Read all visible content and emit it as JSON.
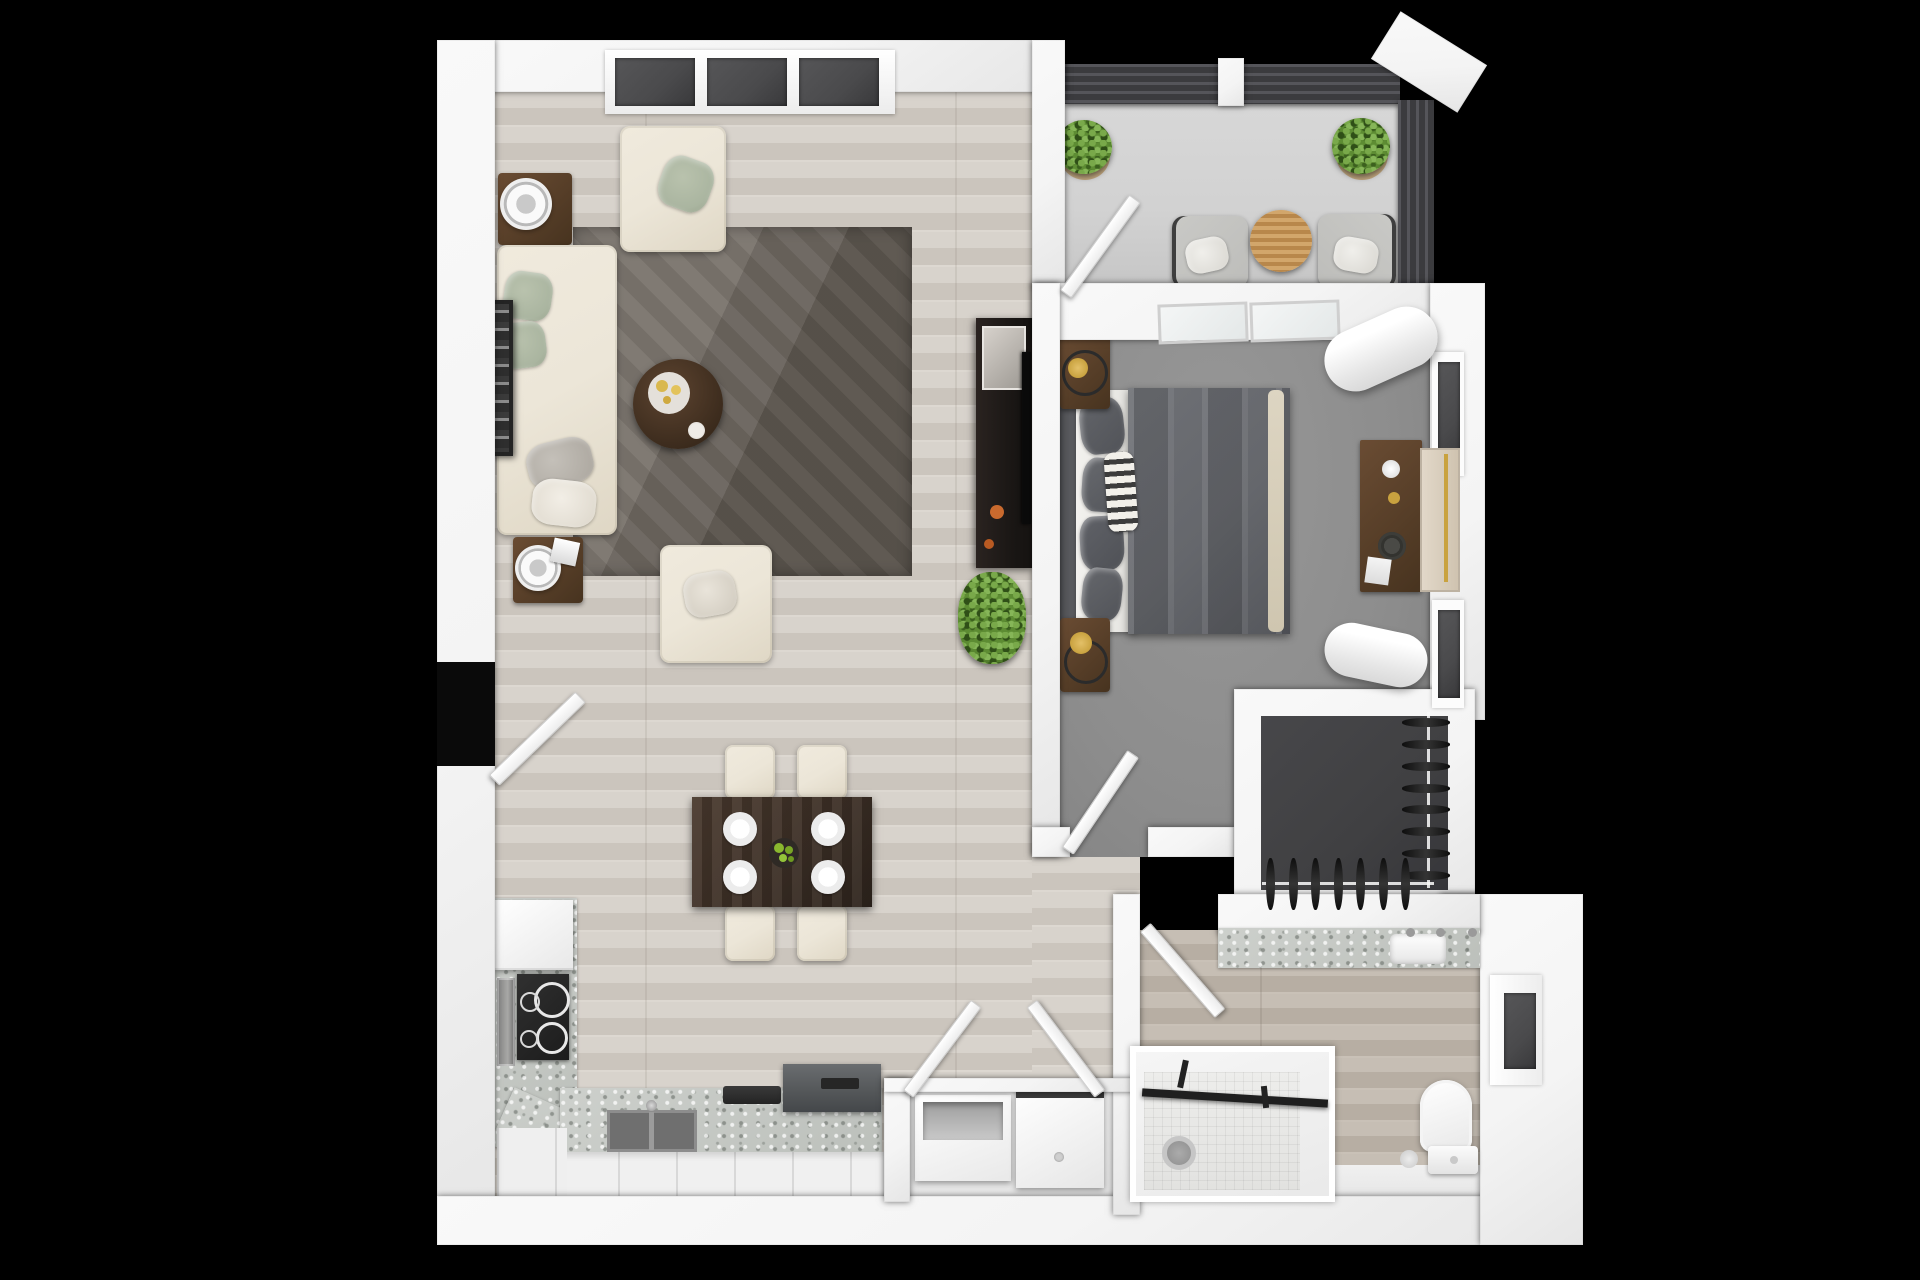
{
  "scene": {
    "type": "3d-rendered-floor-plan",
    "background": "#000000",
    "style": "top-down dollhouse render, furnished one-bedroom apartment"
  },
  "palette": {
    "wall": "#f4f4f4",
    "wall-deep": "#e6e6e6",
    "wood-a": "#d8d3cc",
    "wood-b": "#cbc5bd",
    "bathwood-a": "#c6beb4",
    "bathwood-b": "#b7aea3",
    "carpet": "#8d8d8d",
    "concrete": "#d2d2d2",
    "rug-a": "#7b756e",
    "rug-b": "#5a544d",
    "closet-floor": "#404042",
    "cream": "#ece6d8",
    "sage": "#aab5a0",
    "darkwood-a": "#6a4c33",
    "darkwood-b": "#47331f",
    "table-dark": "#3b2e25",
    "duvet": "#65676c",
    "granite-a": "#cdd0cc",
    "granite-b": "#bcc0bb",
    "appliance": "#55585a",
    "railing": "#3b3b3e",
    "glass": "#4a4a4c",
    "plant": "#5d8c33",
    "plant-dark": "#3f661f",
    "oak": "#c79a5e",
    "gold": "#c9a23f",
    "apple": "#8ab82f",
    "chair-gray": "#bdbdba",
    "tv": "#181513"
  },
  "rooms": [
    {
      "name": "living-room"
    },
    {
      "name": "dining-area"
    },
    {
      "name": "kitchen"
    },
    {
      "name": "balcony"
    },
    {
      "name": "bedroom"
    },
    {
      "name": "walk-in-closet"
    },
    {
      "name": "bathroom"
    },
    {
      "name": "laundry-closet"
    },
    {
      "name": "hallway"
    }
  ],
  "counts": {
    "living_window_panes": 3,
    "bedroom_top_windows": 2,
    "bedroom_side_windows": 2,
    "bathroom_windows": 1,
    "dining_place_settings": 4,
    "dining_chairs": 4,
    "balcony_planters": 2,
    "balcony_chairs": 2,
    "closet_side_garments": 8,
    "closet_bottom_garments": 7,
    "stove_burners": 4,
    "open_doors": 6
  }
}
